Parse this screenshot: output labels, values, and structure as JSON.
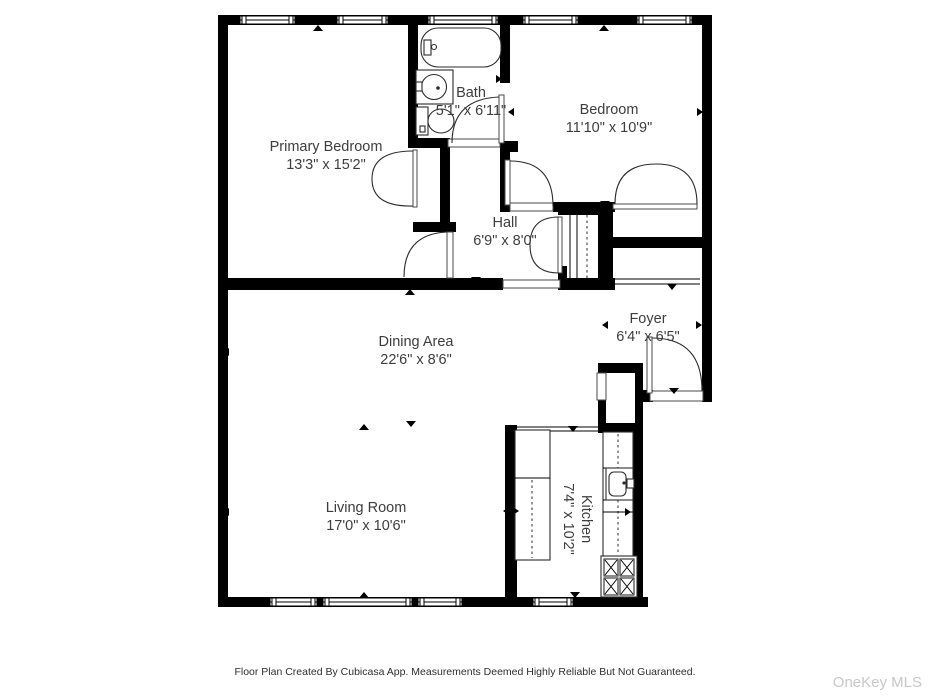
{
  "plan": {
    "rooms": [
      {
        "name": "Primary Bedroom",
        "dims": "13'3\" x 15'2\""
      },
      {
        "name": "Bath",
        "dims": "5'1\" x 6'11\""
      },
      {
        "name": "Bedroom",
        "dims": "11'10\" x 10'9\""
      },
      {
        "name": "Hall",
        "dims": "6'9\" x 8'0\""
      },
      {
        "name": "Foyer",
        "dims": "6'4\" x 6'5\""
      },
      {
        "name": "Dining Area",
        "dims": "22'6\" x 8'6\""
      },
      {
        "name": "Living Room",
        "dims": "17'0\" x 10'6\""
      },
      {
        "name": "Kitchen",
        "dims": "7'4\" x 10'2\""
      }
    ],
    "fixtures": [
      "bathtub-icon",
      "bathroom-sink-icon",
      "toilet-icon",
      "kitchen-sink-icon",
      "stove-4-burner-icon",
      "closet-rod-icon",
      "window-icon",
      "door-swing-icon"
    ],
    "footer": "Floor Plan Created By Cubicasa App. Measurements Deemed Highly Reliable But Not Guaranteed.",
    "watermark": "OneKey MLS",
    "colors": {
      "wall": "#000000",
      "background": "#ffffff",
      "label": "#3d3d3d",
      "watermark": "#c7c7c7"
    }
  }
}
